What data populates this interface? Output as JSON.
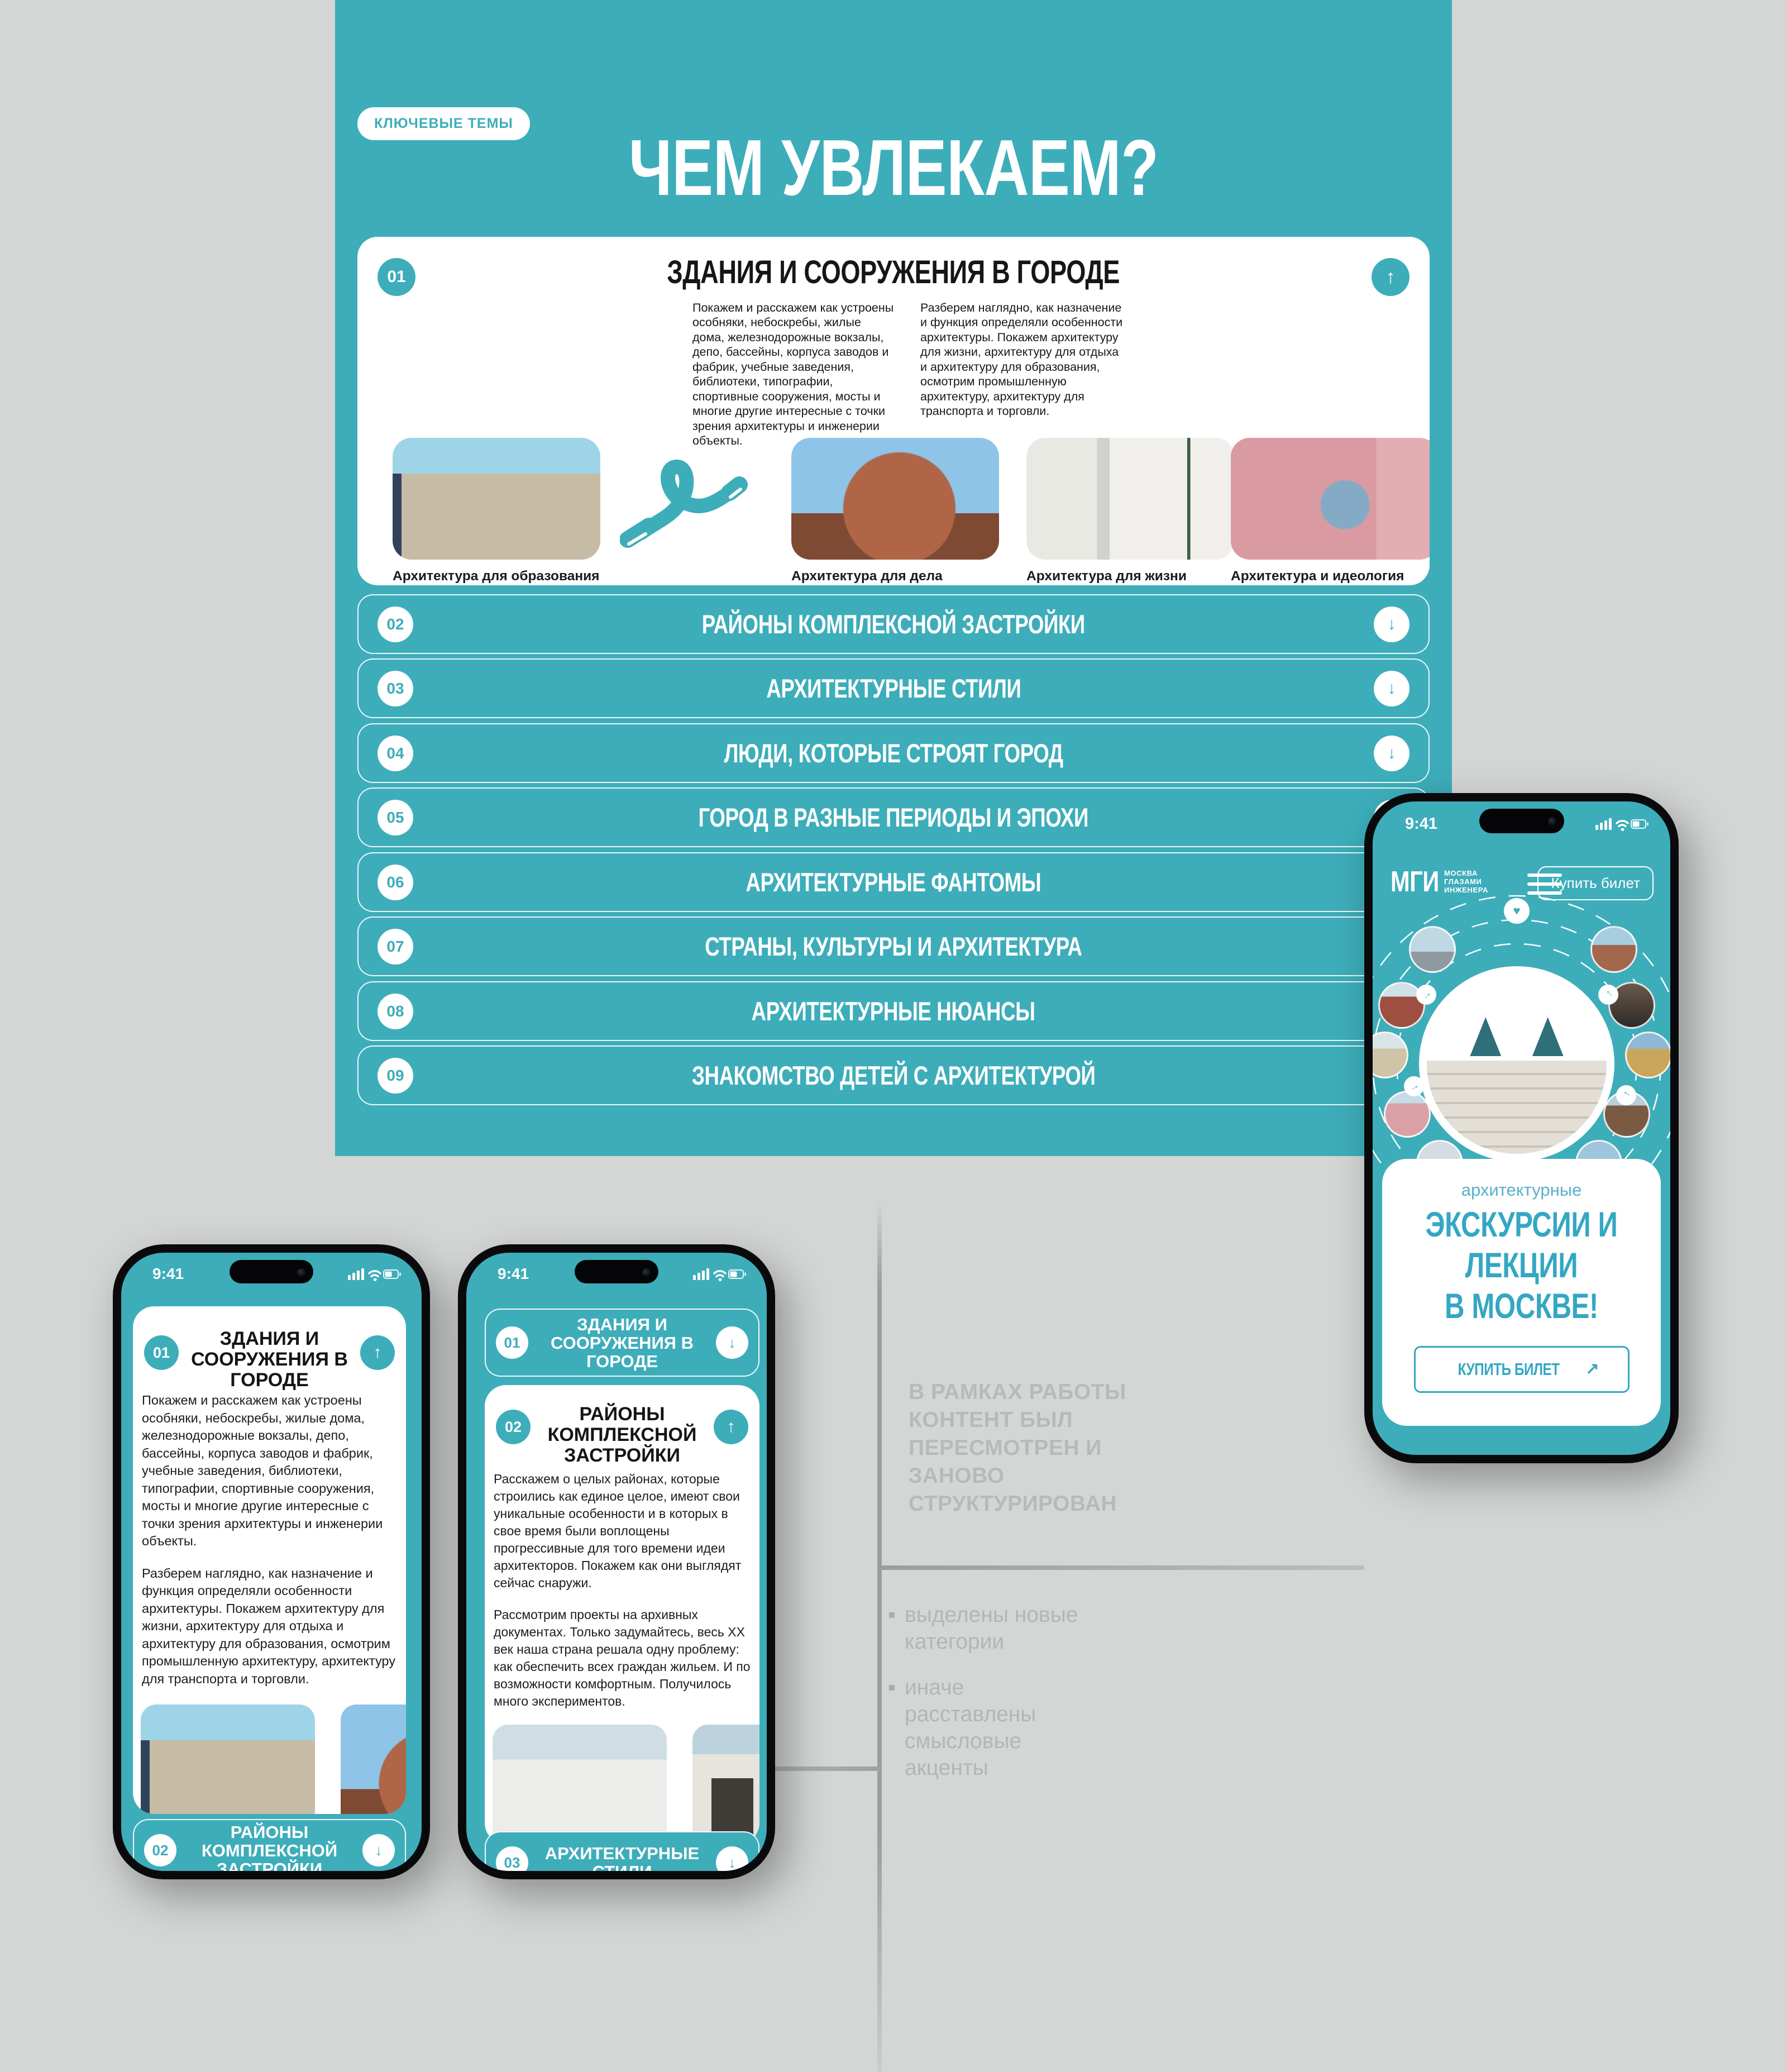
{
  "colors": {
    "teal": "#3dadba",
    "accent": "#34a7c3",
    "kicker": "#57b1cc",
    "background": "#d3d6d5",
    "ink": "#141617",
    "caption_gray": "#9ea3a4",
    "annotation_gray": "#b4b8b7",
    "line_gray": "#9a9e9d"
  },
  "icons": {
    "up": "↑",
    "down": "↓",
    "ne": "↗",
    "heart": "♥"
  },
  "header": {
    "badge": "КЛЮЧЕВЫЕ ТЕМЫ",
    "title": "ЧЕМ УВЛЕКАЕМ?",
    "subtitle": "Мы показываем, как устроен город, учим\nчитать его язык: рассказываем об\nархитектуре и инженерном искусстве."
  },
  "s1": {
    "num": "01",
    "title": "ЗДАНИЯ И СООРУЖЕНИЯ В ГОРОДЕ",
    "col1": "Покажем и расскажем как устроены особняки, небоскребы, жилые дома, железнодорожные вокзалы, депо, бассейны, корпуса заводов и фабрик, учебные заведения, библиотеки, типографии, спортивные сооружения, мосты и многие другие интересные с точки зрения архитектуры и инженерии объекты.",
    "col2": "Разберем наглядно, как назначение и функция определяли особенности архитектуры. Покажем архитектуру для жизни, архитектуру для отдыха и архитектуру для образования, осмотрим промышленную архитектуру, архитектуру для транспорта и торговли.",
    "photos": [
      {
        "caption": "Архитектура для образования",
        "sub": "БИБЛИОТЕКА ИМ.ЛЕНИНА"
      },
      {
        "caption": "Архитектура для дела",
        "sub": "ХЛЕБОЗАВОД №9"
      },
      {
        "caption": "Архитектура для жизни",
        "sub": "РАЙОН ДАНГАУЭРОВКА"
      },
      {
        "caption": "Архитектура и идеология",
        "sub": "ДОМ КУЛЬТУРЫ ИМ.ЗУЕВА"
      }
    ]
  },
  "accordion": {
    "rows": [
      {
        "num": "02",
        "title": "РАЙОНЫ КОМПЛЕКСНОЙ ЗАСТРОЙКИ"
      },
      {
        "num": "03",
        "title": "АРХИТЕКТУРНЫЕ СТИЛИ"
      },
      {
        "num": "04",
        "title": "ЛЮДИ, КОТОРЫЕ СТРОЯТ ГОРОД"
      },
      {
        "num": "05",
        "title": "ГОРОД В РАЗНЫЕ ПЕРИОДЫ И ЭПОХИ"
      },
      {
        "num": "06",
        "title": "АРХИТЕКТУРНЫЕ ФАНТОМЫ"
      },
      {
        "num": "07",
        "title": "СТРАНЫ, КУЛЬТУРЫ И АРХИТЕКТУРА"
      },
      {
        "num": "08",
        "title": "АРХИТЕКТУРНЫЕ НЮАНСЫ"
      },
      {
        "num": "09",
        "title": "ЗНАКОМСТВО ДЕТЕЙ С АРХИТЕКТУРОЙ"
      }
    ]
  },
  "annotation": {
    "heading": "В РАМКАХ РАБОТЫ\nКОНТЕНТ БЫЛ\nПЕРЕСМОТРЕН И\nЗАНОВО\nСТРУКТУРИРОВАН",
    "bullets": [
      "выделены новые\nкатегории",
      "иначе\nрасставлены\nсмысловые\nакценты"
    ]
  },
  "brand": {
    "abbr": "МГИ",
    "sub": "МОСКВА\nГЛАЗАМИ\nИНЖЕНЕРА"
  },
  "phoneHome": {
    "time": "9:41",
    "buy": "Купить билет",
    "kicker": "архитектурные",
    "headline": "ЭКСКУРСИИ И\nЛЕКЦИИ\nВ МОСКВЕ!",
    "cta": "КУПИТЬ БИЛЕТ"
  },
  "phone1": {
    "time": "9:41",
    "card": {
      "num": "01",
      "title": "ЗДАНИЯ И\nСООРУЖЕНИЯ В\nГОРОДЕ",
      "p1": "Покажем и расскажем как устроены особняки, небоскребы, жилые дома, железнодорожные вокзалы, депо, бассейны, корпуса заводов и фабрик, учебные заведения, библиотеки, типографии, спортивные сооружения, мосты и многие другие интересные с точки зрения архитектуры и инженерии объекты.",
      "p2": "Разберем наглядно, как назначение и функция определяли особенности архитектуры. Покажем архитектуру для жизни, архитектуру для отдыха и архитектуру для образования, осмотрим промышленную архитектуру, архитектуру для транспорта и торговли.",
      "photos": [
        {
          "caption": "Архитектура для образования",
          "sub": "БИБЛИОТЕКА ИМ.ЛЕНИНА"
        },
        {
          "caption": "Архитектура для дела",
          "sub": "ХЛЕБОЗАВОД №9"
        }
      ]
    },
    "row": {
      "num": "02",
      "title": "РАЙОНЫ\nКОМПЛЕКСНОЙ\nЗАСТРОЙКИ"
    }
  },
  "phone2": {
    "time": "9:41",
    "row1": {
      "num": "01",
      "title": "ЗДАНИЯ И\nСООРУЖЕНИЯ В\nГОРОДЕ"
    },
    "card": {
      "num": "02",
      "title": "РАЙОНЫ\nКОМПЛЕКСНОЙ\nЗАСТРОЙКИ",
      "p1": "Расскажем о целых районах, которые строились как единое целое, имеют свои уникальные особенности и в которых в свое время были воплощены прогрессивные для того времени идеи архитекторов. Покажем как они выглядят сейчас снаружи.",
      "p2": "Рассмотрим проекты на архивных документах. Только задумайтесь, весь ХХ век наша страна решала одну проблему: как обеспечить всех граждан жильем. И по возможности комфортным. Получилось много экспериментов.",
      "photos": [
        {
          "caption": "Рабочий поселок “Усачевка”",
          "sub": "м.СПОРТИВНАЯ"
        },
        {
          "caption": "Район “Дангауэровка”",
          "sub": "м.АВИАМОТОРНАЯ"
        }
      ]
    },
    "row3": {
      "num": "03",
      "title": "АРХИТЕКТУРНЫЕ\nСТИЛИ"
    }
  }
}
